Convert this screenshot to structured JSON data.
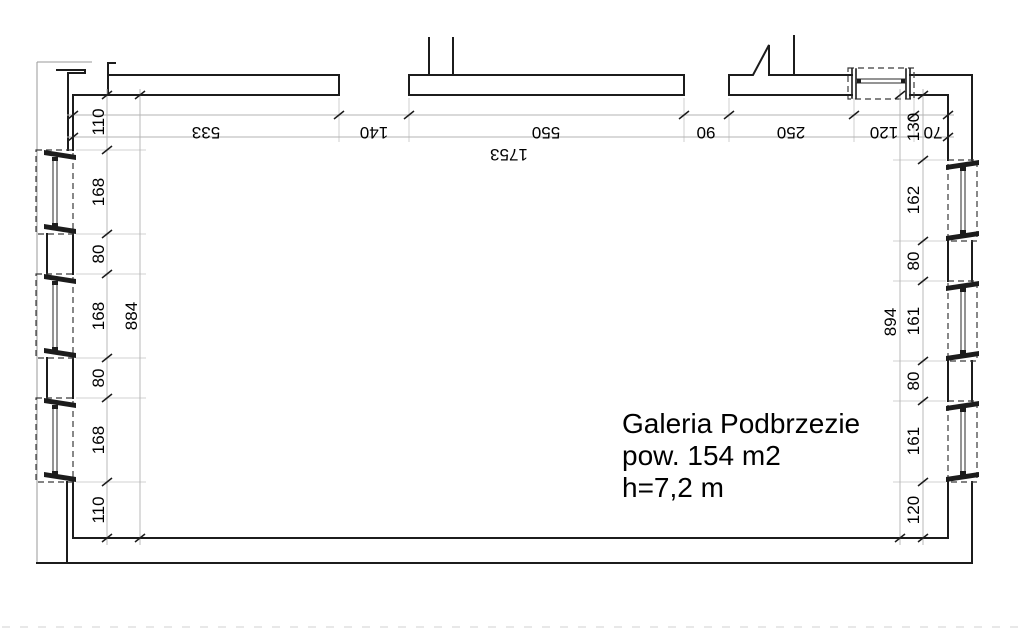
{
  "drawing": {
    "room": {
      "name": "Galeria Podbrzezie",
      "area": "pow. 154 m2",
      "height": "h=7,2 m"
    },
    "dims": {
      "top": [
        "533",
        "140",
        "550",
        "90",
        "250",
        "120",
        "70"
      ],
      "top_total": "1753",
      "left": [
        "110",
        "168",
        "80",
        "168",
        "80",
        "168",
        "110"
      ],
      "left_total": "884",
      "right": [
        "130",
        "162",
        "80",
        "161",
        "80",
        "161",
        "120"
      ],
      "right_total": "894"
    },
    "colors": {
      "wall": "#1c1c1c",
      "dimension_line": "#b3b3b3",
      "text": "#000000",
      "background": "#ffffff"
    }
  }
}
